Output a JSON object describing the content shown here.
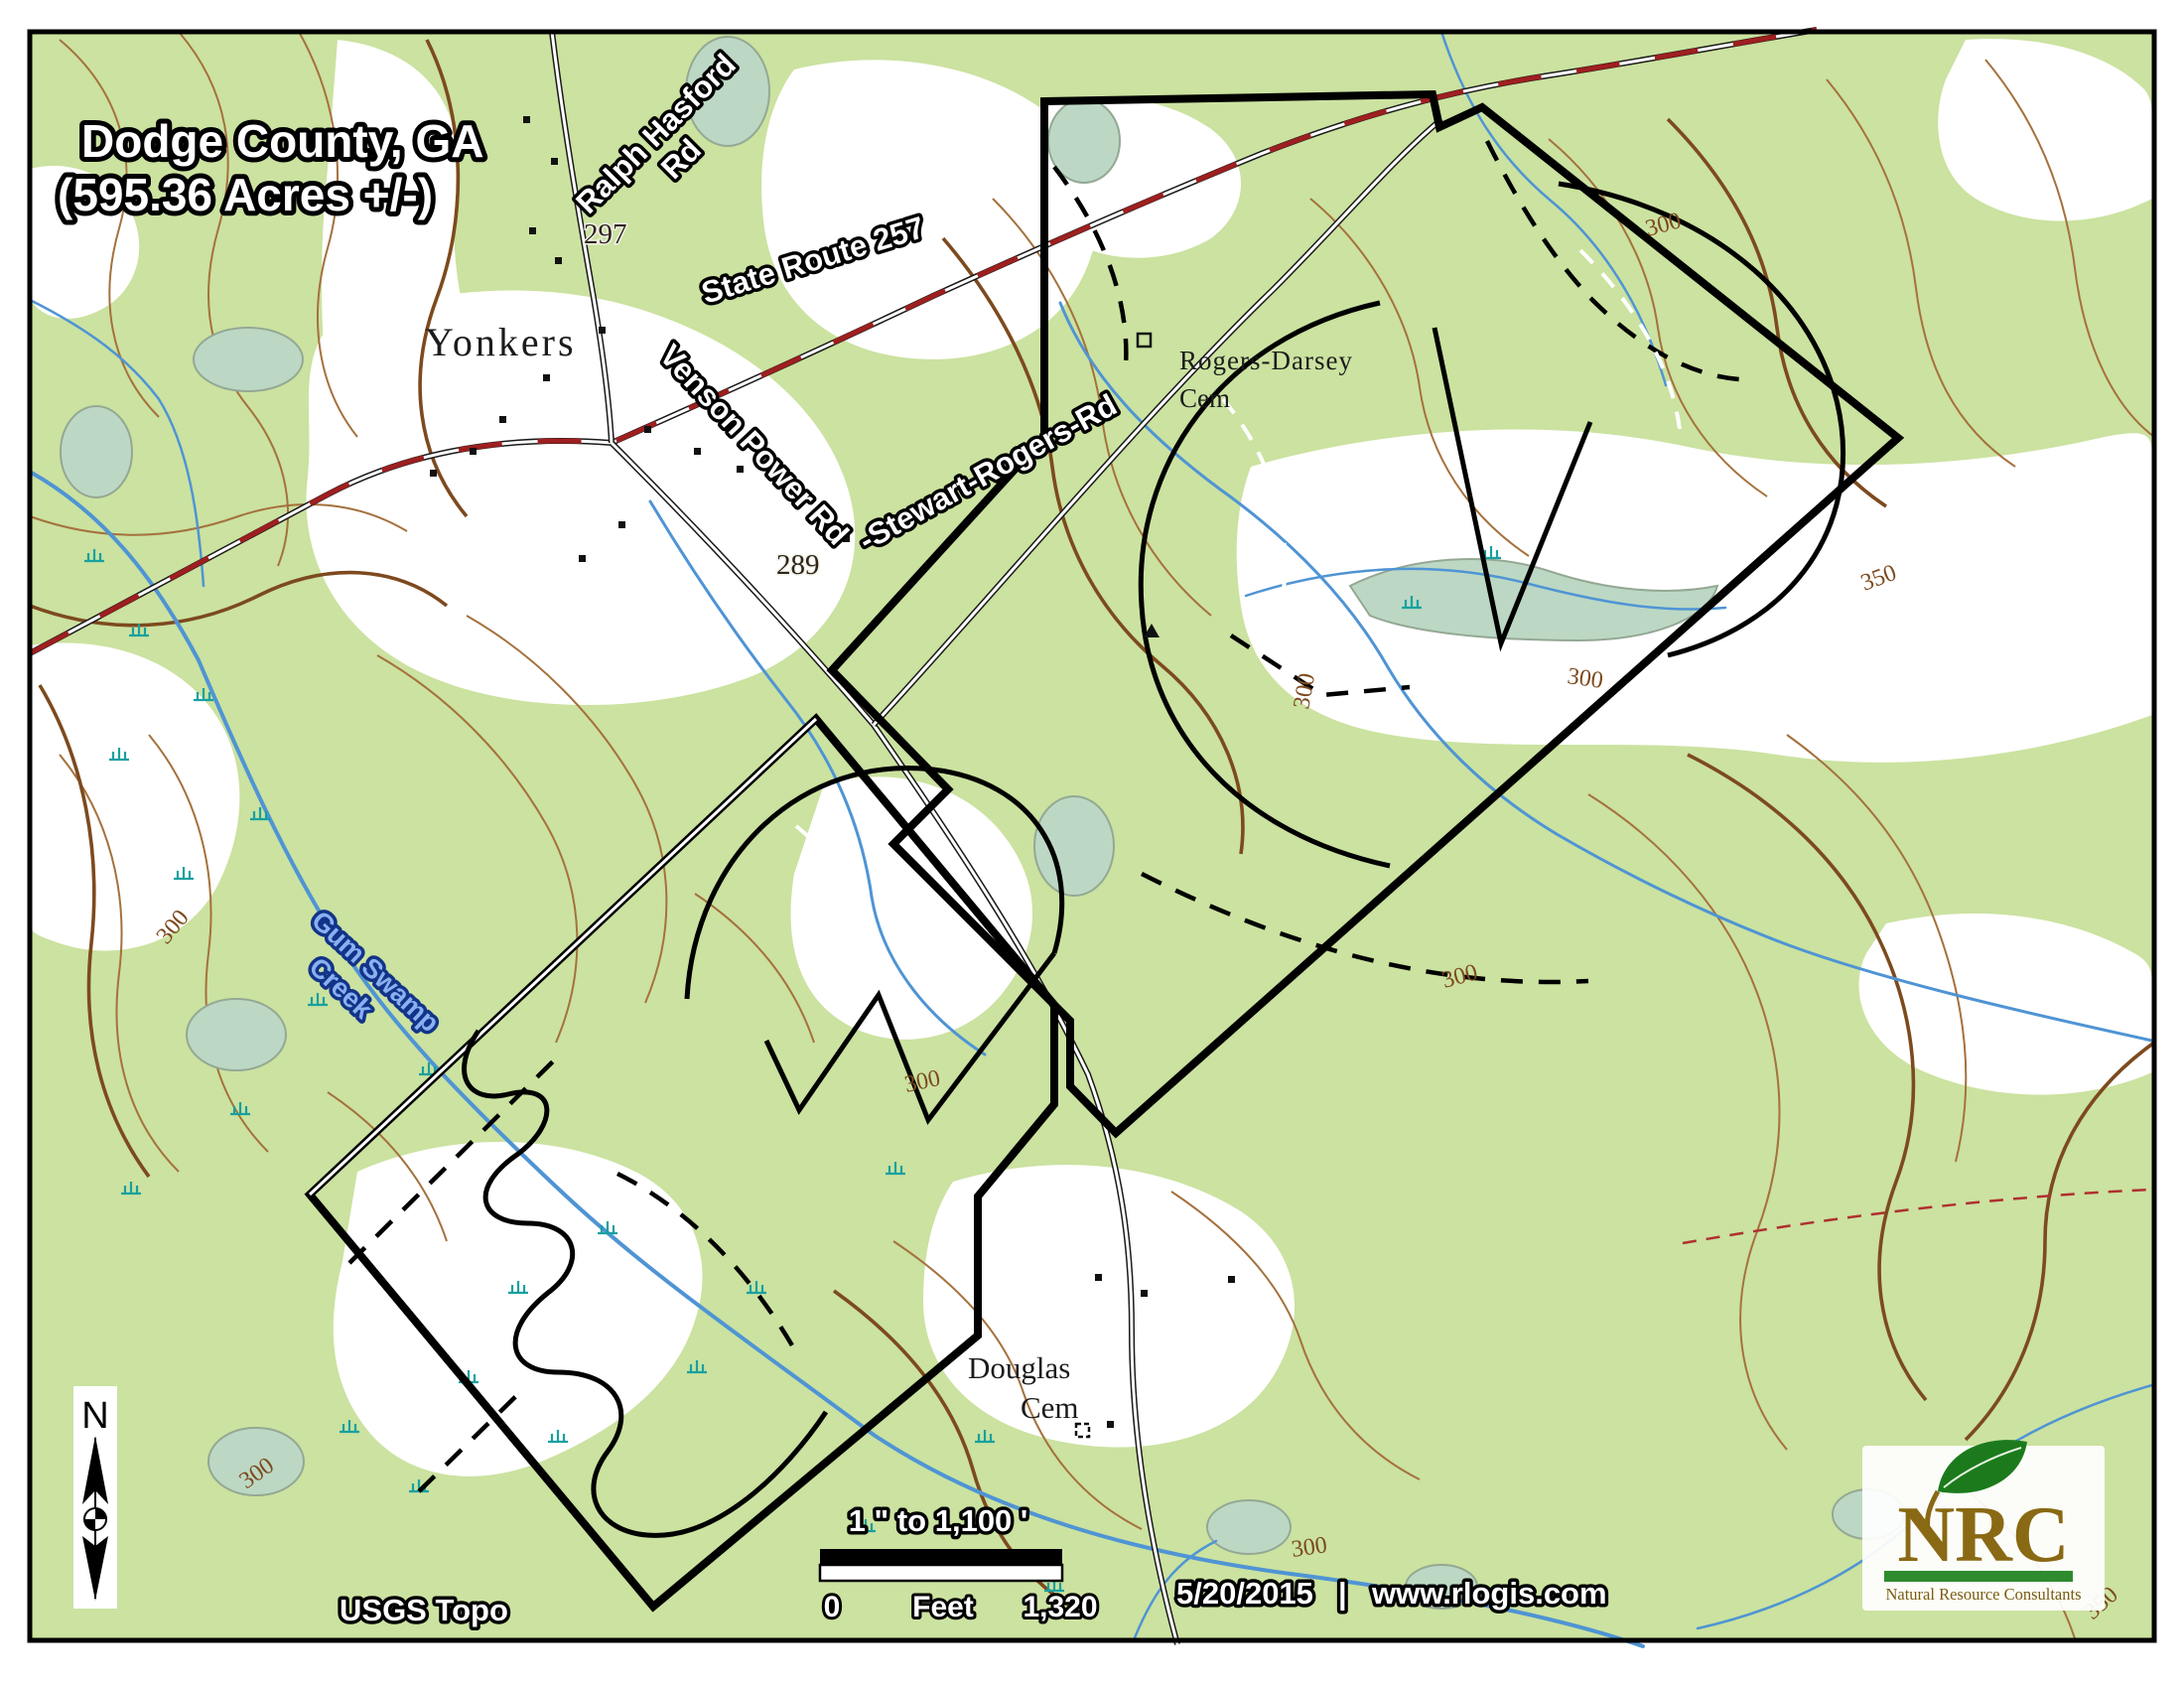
{
  "map": {
    "title": {
      "line1": "Dodge County, GA",
      "line2": "(595.36 Acres +/-)"
    },
    "roads": {
      "ralph_hasford_line1": "Ralph Hasford",
      "ralph_hasford_line2": "Rd",
      "state_route": "State Route 257",
      "venson_power": "Venson Power Rd",
      "stewart_rogers": "-Stewart-Rogers-Rd"
    },
    "places": {
      "town": "Yonkers",
      "cemetery1_line1": "Rogers-Darsey",
      "cemetery1_line2": "Cem",
      "cemetery2_line1": "Douglas",
      "cemetery2_line2": "Cem"
    },
    "water": {
      "creek_line1": "Gum Swamp",
      "creek_line2": "Creek"
    },
    "contour_labels": [
      {
        "text": "297"
      },
      {
        "text": "289"
      },
      {
        "text": "300"
      },
      {
        "text": "300"
      },
      {
        "text": "300"
      },
      {
        "text": "300"
      },
      {
        "text": "300"
      },
      {
        "text": "300"
      },
      {
        "text": "300"
      },
      {
        "text": "300"
      },
      {
        "text": "350"
      },
      {
        "text": "350"
      }
    ],
    "scalebar": {
      "ratio": "1 \" to 1,100 '",
      "zero": "0",
      "unit": "Feet",
      "max": "1,320"
    },
    "footer": {
      "source": "USGS Topo",
      "date": "5/20/2015",
      "separator": "|",
      "website": "www.rlogis.com"
    },
    "north_arrow": {
      "label": "N"
    },
    "logo": {
      "acronym": "NRC",
      "tagline": "Natural Resource Consultants"
    },
    "colors": {
      "vegetation": "#cbe2a0",
      "clearing": "#ffffff",
      "contour": "#a5713d",
      "contour_index": "#7d4a1e",
      "stream": "#4f94d4",
      "marsh": "#18a0a0",
      "highway_dash": "#9e1f1f",
      "boundary": "#000000",
      "pond_fill": "#bcd8c4",
      "creek_label_fill": "#8ab0f2",
      "logo_gold": "#8a6914",
      "logo_green": "#2e8b2e"
    }
  }
}
